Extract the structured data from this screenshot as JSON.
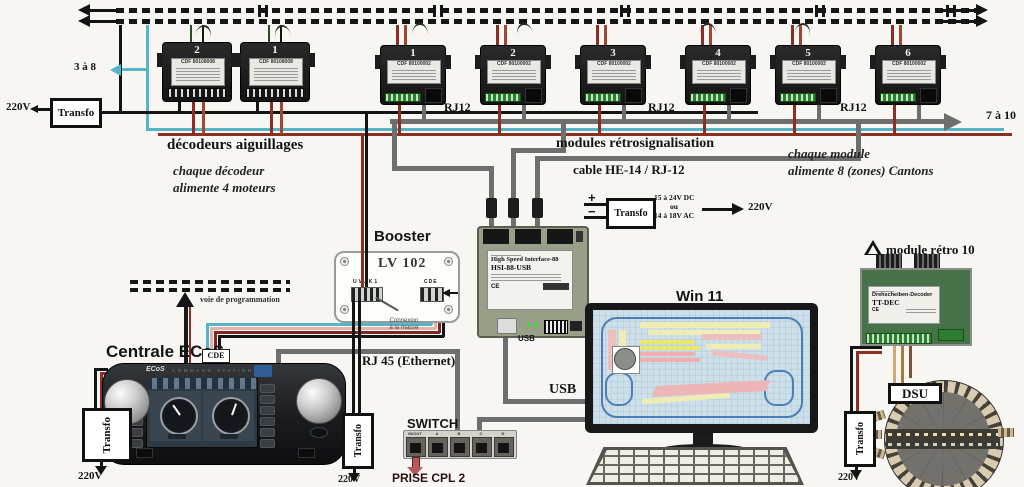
{
  "ranges": {
    "left": "3 à 8",
    "right": "7 à 10"
  },
  "power": {
    "transfo": "Transfo",
    "mains": "220V",
    "plus": "+",
    "minus": "−",
    "dc": "15 à 24V DC",
    "or": "ou",
    "ac": "14 à 18V AC"
  },
  "decoders": {
    "title": "décodeurs aiguillages",
    "note1": "chaque décodeur",
    "note2": "alimente 4 moteurs",
    "units": [
      "2",
      "1"
    ],
    "sticker": "CDF 80108008"
  },
  "retro": {
    "title": "modules rétrosignalisation",
    "cable_label": "cable HE-14 / RJ-12",
    "note1": "chaque module",
    "note2": "alimente 8 (zones) Cantons",
    "units": [
      "1",
      "2",
      "3",
      "4",
      "5",
      "6"
    ],
    "sticker": "CDF 80100002",
    "rj12": "RJ12"
  },
  "booster": {
    "title": "Booster",
    "model": "LV 102",
    "left_terminal": "UVJK1",
    "right_terminal": "CDE",
    "ground1": "Connexion",
    "ground2": "à la masse"
  },
  "hsi": {
    "line1": "High Speed Interface-88",
    "line2": "HSI-88-USB",
    "ce": "CE",
    "usb_port": "USB"
  },
  "pc": {
    "os": "Win 11",
    "usb": "USB"
  },
  "ecos": {
    "title": "Centrale ECoS",
    "brand": "ECoS",
    "topline": "COMMAND STATION",
    "cde": "CDE",
    "prog": "voie de programmation"
  },
  "network": {
    "rj45": "RJ 45 (Ethernet)",
    "switch": "SWITCH",
    "ports": [
      "IN/OUT",
      "A",
      "B",
      "C",
      "D"
    ],
    "cpl": "PRISE CPL 2"
  },
  "retro10": {
    "label": "module rétro 10",
    "line1": "Drehscheiben-Decoder",
    "line2": "TT-DEC",
    "ce": "CE",
    "dsu": "DSU"
  }
}
